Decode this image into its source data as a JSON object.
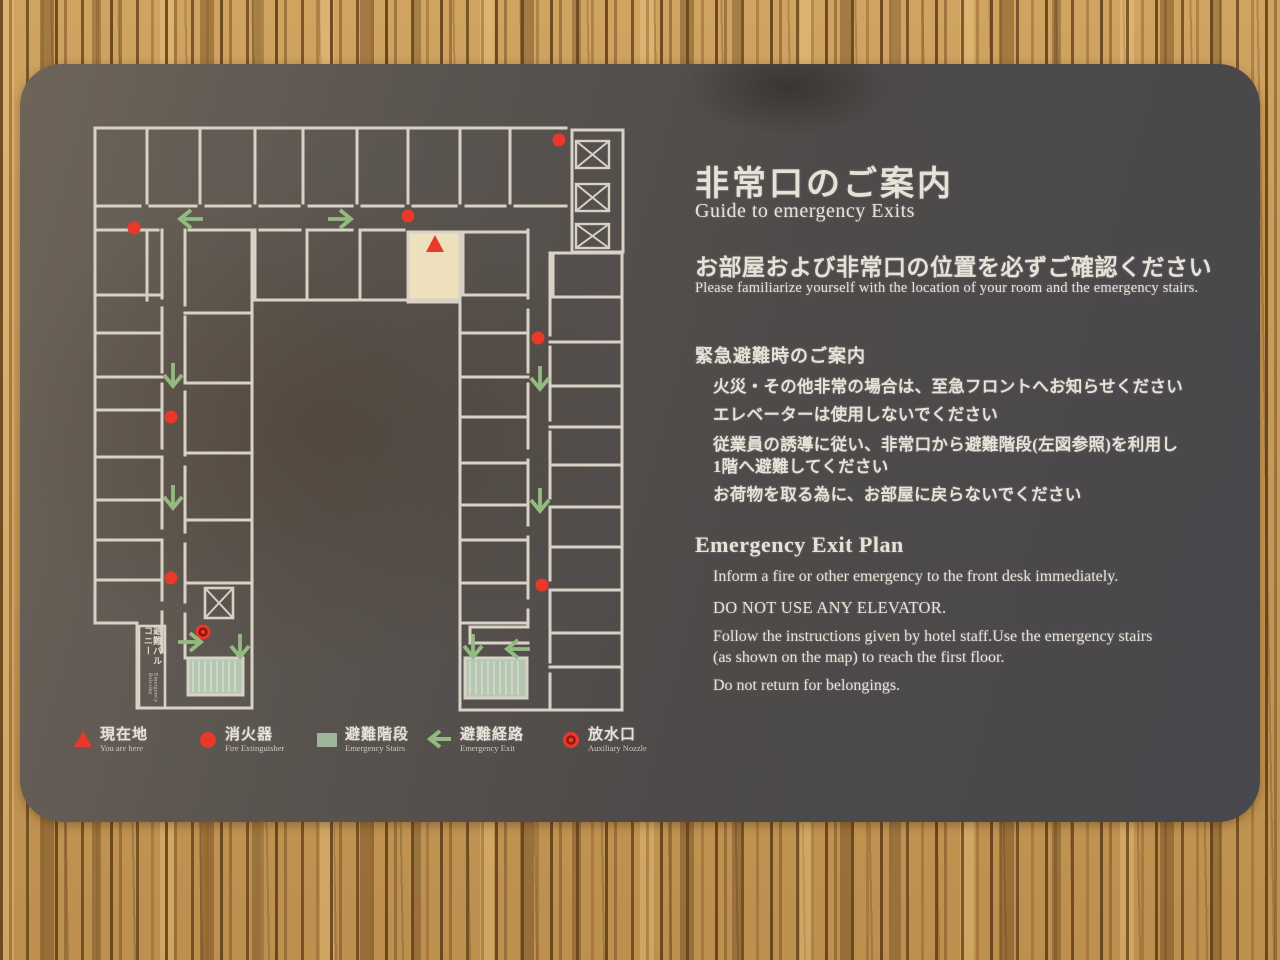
{
  "sign": {
    "title_jp": "非常口のご案内",
    "title_en": "Guide to emergency Exits",
    "notice_jp": "お部屋および非常口の位置を必ずご確認ください",
    "notice_en": "Please familiarize yourself with the location of your room and the emergency stairs.",
    "evac_heading_jp": "緊急避難時のご案内",
    "evac_items_jp": [
      "火災・その他非常の場合は、至急フロントへお知らせください",
      "エレベーターは使用しないでください",
      "従業員の誘導に従い、非常口から避難階段(左図参照)を利用し\n1階へ避難してください",
      "お荷物を取る為に、お部屋に戻らないでください"
    ],
    "plan_heading_en": "Emergency Exit Plan",
    "plan_items_en": [
      "Inform a fire or other emergency to the front desk immediately.",
      "DO NOT USE ANY ELEVATOR.",
      "Follow the instructions given by hotel staff.Use the emergency stairs\n(as shown on the map) to reach the first floor.",
      "Do not return for belongings."
    ]
  },
  "legend": [
    {
      "symbol": "triangle",
      "jp": "現在地",
      "en": "You are here"
    },
    {
      "symbol": "dot",
      "jp": "消火器",
      "en": "Fire Extinguisher"
    },
    {
      "symbol": "square",
      "jp": "避難階段",
      "en": "Emergency Stairs"
    },
    {
      "symbol": "arrow",
      "jp": "避難経路",
      "en": "Emergency Exit"
    },
    {
      "symbol": "nozzle",
      "jp": "放水口",
      "en": "Auxiliary Nozzle"
    }
  ],
  "map": {
    "balcony_label_jp": "避難バルコニー",
    "balcony_label_en": "Emergency Balcony",
    "colors": {
      "wall": "#d8d2c6",
      "red": "#e8392a",
      "nozzle_ring": "#8d170c",
      "green": "#93bb80",
      "stairs": "#b5c7b1",
      "highlight": "#eee0bc"
    },
    "markers": {
      "extinguishers": [
        [
          134,
          228
        ],
        [
          408,
          216
        ],
        [
          559,
          140
        ],
        [
          171,
          417
        ],
        [
          171,
          578
        ],
        [
          538,
          338
        ],
        [
          542,
          585
        ]
      ],
      "you_are_here": [
        435,
        245
      ],
      "nozzle": [
        203,
        632
      ],
      "arrows": [
        {
          "dir": "left",
          "x": 191,
          "y": 219
        },
        {
          "dir": "right",
          "x": 340,
          "y": 219
        },
        {
          "dir": "down",
          "x": 173,
          "y": 375
        },
        {
          "dir": "down",
          "x": 173,
          "y": 497
        },
        {
          "dir": "down",
          "x": 540,
          "y": 378
        },
        {
          "dir": "down",
          "x": 540,
          "y": 500
        },
        {
          "dir": "right",
          "x": 190,
          "y": 642
        },
        {
          "dir": "down",
          "x": 240,
          "y": 646
        },
        {
          "dir": "down",
          "x": 473,
          "y": 646
        },
        {
          "dir": "left",
          "x": 518,
          "y": 649
        }
      ]
    }
  }
}
